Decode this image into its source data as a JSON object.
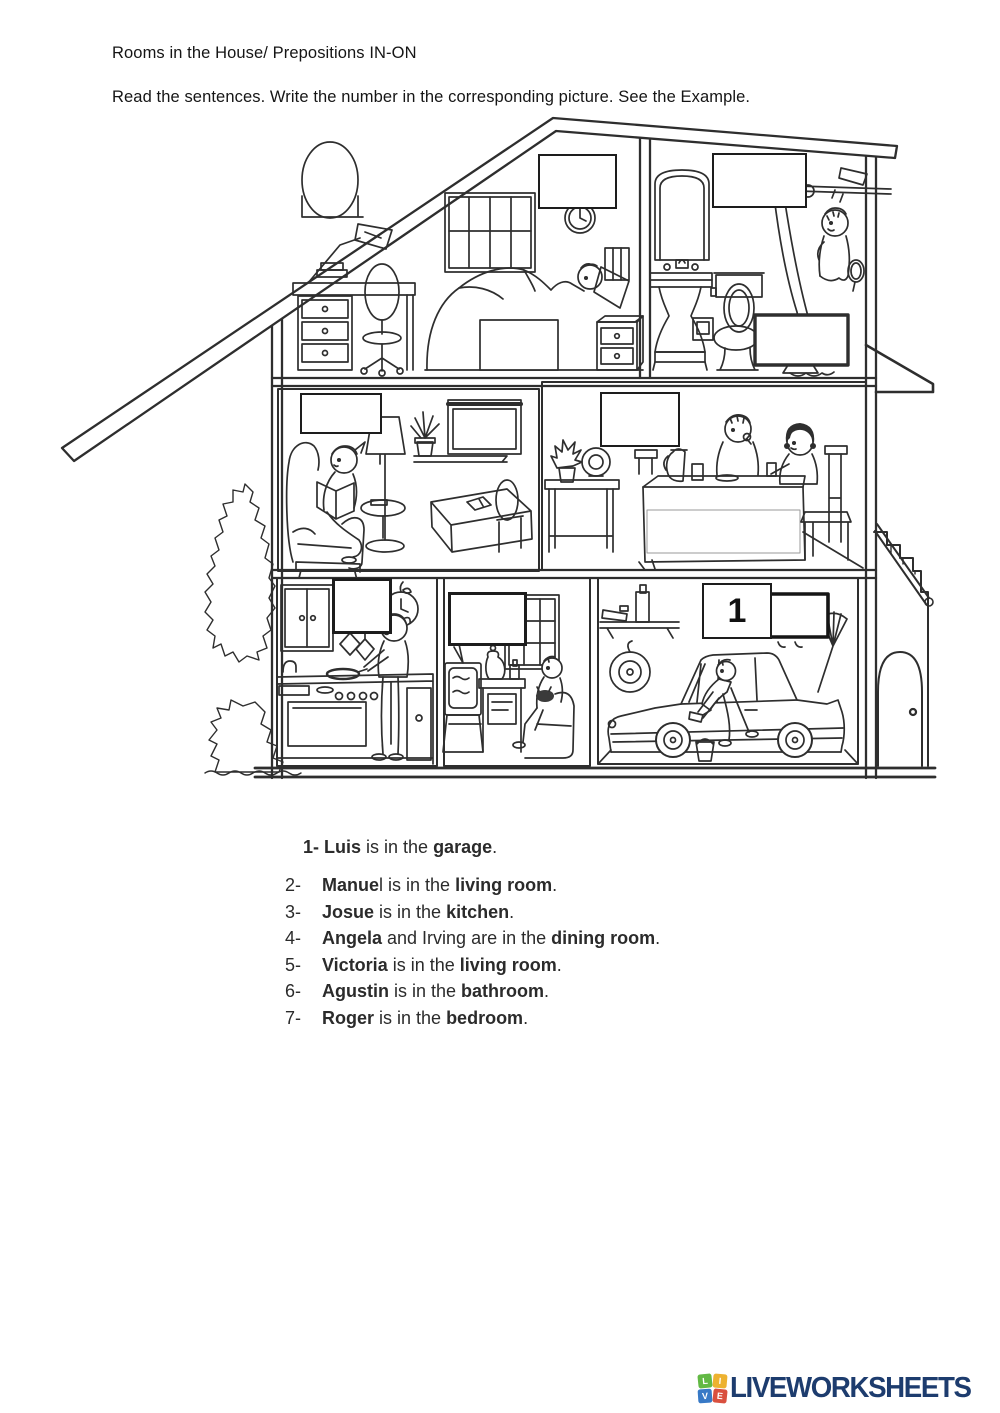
{
  "page": {
    "title": "Rooms in the House/ Prepositions IN-ON",
    "instructions": "Read the sentences. Write the number in the corresponding picture. See the Example."
  },
  "illustration": {
    "description": "Cross-section dollhouse drawing with bedroom, bathroom, living room, dining room, kitchen, TV living room and garage"
  },
  "answers": {
    "bedroom": {
      "room": "bedroom",
      "value": ""
    },
    "bathroom": {
      "room": "bathroom",
      "value": ""
    },
    "living_room": {
      "room": "living room",
      "value": ""
    },
    "dining_room": {
      "room": "dining room",
      "value": ""
    },
    "kitchen": {
      "room": "kitchen",
      "value": ""
    },
    "tv_room": {
      "room": "living room",
      "value": ""
    },
    "garage": {
      "room": "garage",
      "value": "1"
    }
  },
  "sentences": {
    "example": {
      "bold_lead": "1- Luis",
      "mid": " is in the ",
      "bold_place": "garage",
      "end": "."
    },
    "items": [
      {
        "num": "2-",
        "bold_name": "Manue",
        "name_tail": "l",
        "mid": " is in the ",
        "bold_place": "living room",
        "end": "."
      },
      {
        "num": "3-",
        "bold_name": "Josue",
        "name_tail": "",
        "mid": " is in the ",
        "bold_place": "kitchen",
        "end": "."
      },
      {
        "num": "4-",
        "bold_name": "Angela",
        "name_tail": "",
        "mid": " and Irving are in the ",
        "bold_place": "dining room",
        "end": "."
      },
      {
        "num": "5-",
        "bold_name": "Victoria",
        "name_tail": "",
        "mid": " is in the ",
        "bold_place": "living room",
        "end": "."
      },
      {
        "num": "6-",
        "bold_name": "Agustin",
        "name_tail": "",
        "mid": " is in the ",
        "bold_place": "bathroom",
        "end": "."
      },
      {
        "num": "7-",
        "bold_name": "Roger",
        "name_tail": "",
        "mid": " is in the ",
        "bold_place": "bedroom",
        "end": "."
      }
    ]
  },
  "footer": {
    "brand": "LIVEWORKSHEETS",
    "brand_color": "#1d3c6e",
    "squares": [
      {
        "letter": "L",
        "color": "#62b944"
      },
      {
        "letter": "I",
        "color": "#edb230"
      },
      {
        "letter": "V",
        "color": "#3779c6"
      },
      {
        "letter": "E",
        "color": "#d9503f"
      }
    ]
  }
}
